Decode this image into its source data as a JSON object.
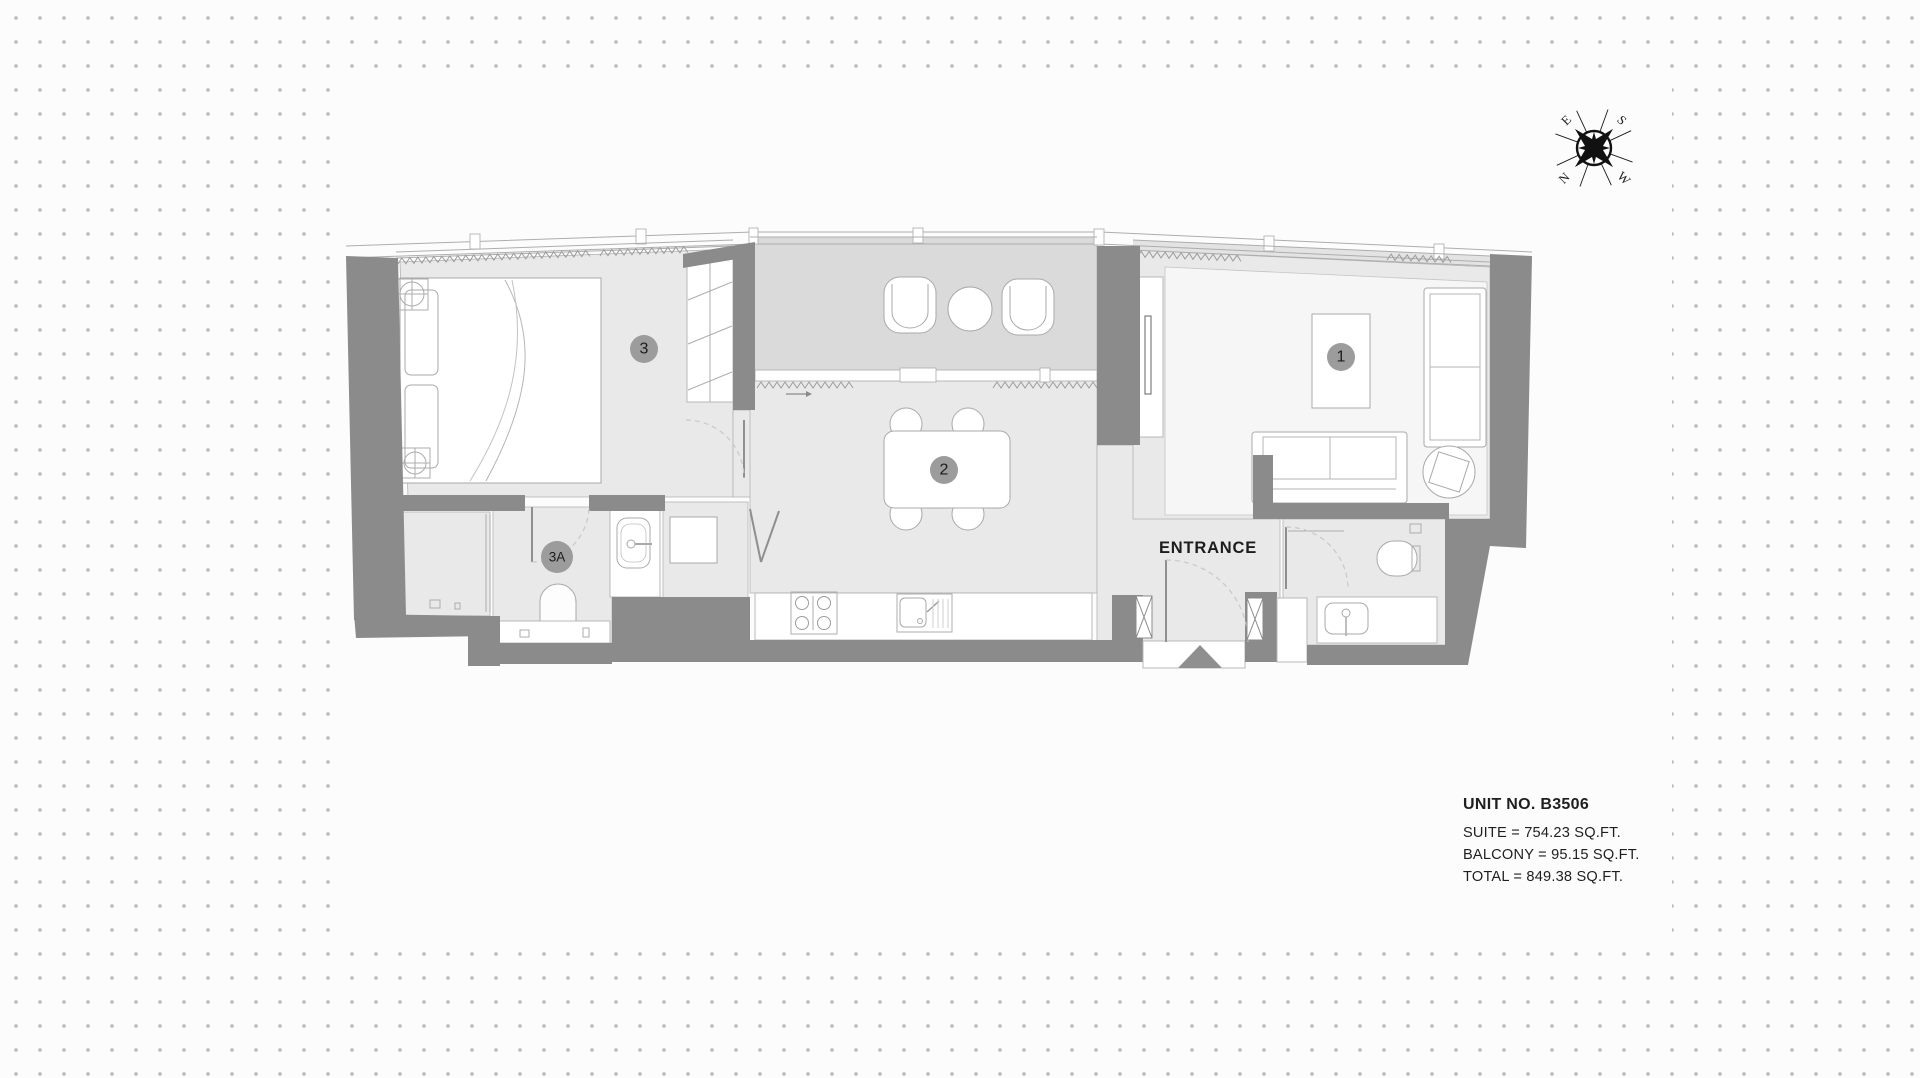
{
  "title_block": {
    "unit": "UNIT NO. B3506",
    "suite": "SUITE = 754.23 SQ.FT.",
    "balcony": "BALCONY = 95.15 SQ.FT.",
    "total": "TOTAL = 849.38 SQ.FT."
  },
  "labels": {
    "entrance": "ENTRANCE",
    "room_living": "1",
    "room_dining": "2",
    "room_bedroom": "3",
    "room_bath": "3A"
  },
  "compass": {
    "north": "N",
    "east": "E",
    "south": "S",
    "west": "W"
  },
  "colors": {
    "background": "#fcfcfc",
    "dot": "#bcbcbc",
    "wall": "#8b8b8b",
    "floor": "#e9e9e9",
    "balcony_floor": "#dadada",
    "badge": "#9c9c9c",
    "text": "#1f1f1f"
  }
}
